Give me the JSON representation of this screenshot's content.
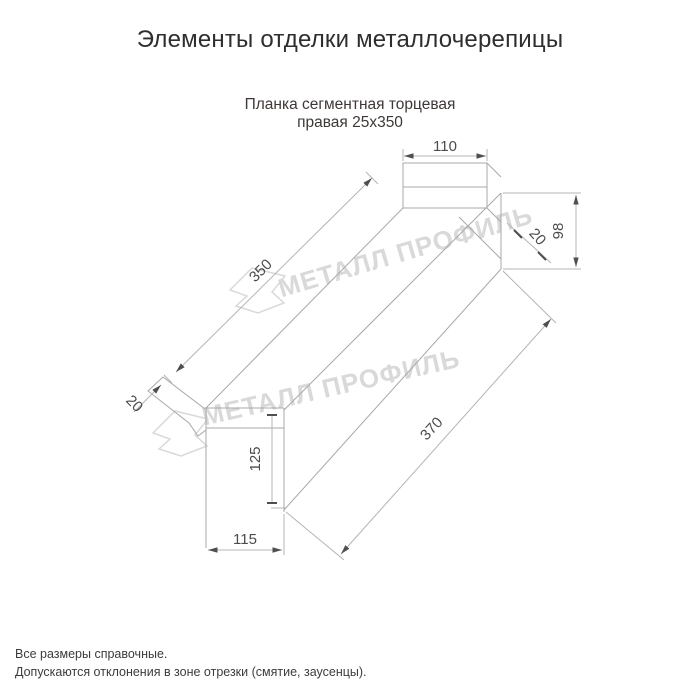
{
  "page": {
    "title": "Элементы отделки металлочерепицы"
  },
  "product": {
    "name_line1": "Планка сегментная торцевая",
    "name_line2": "правая 25x350"
  },
  "drawing": {
    "watermark_text": "МЕТАЛЛ ПРОФИЛЬ",
    "dims": {
      "flange_width": "110",
      "end_height": "98",
      "end_hem": "20",
      "top_length": "350",
      "left_hem": "20",
      "left_height": "125",
      "left_width": "115",
      "bottom_length": "370"
    },
    "colors": {
      "line": "#a8a8a8",
      "dim_text": "#4c4c4c",
      "watermark": "#d9d9d9"
    }
  },
  "footer": {
    "note_1": "Все размеры справочные.",
    "note_2": "Допускаются отклонения в зоне отрезки (смятие, заусенцы)."
  }
}
